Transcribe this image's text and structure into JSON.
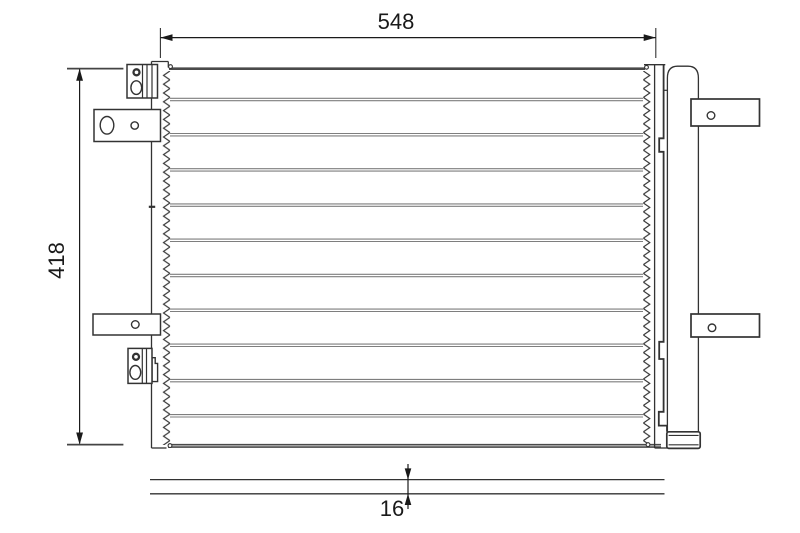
{
  "drawing": {
    "dimensions": {
      "width_label": "548",
      "height_label": "418",
      "depth_label": "16"
    },
    "colors": {
      "outline": "#333333",
      "tube_line": "#7e7e7e",
      "core_plate": "#4a4a4a",
      "dimension": "#1a1a1a",
      "background": "#ffffff"
    }
  }
}
